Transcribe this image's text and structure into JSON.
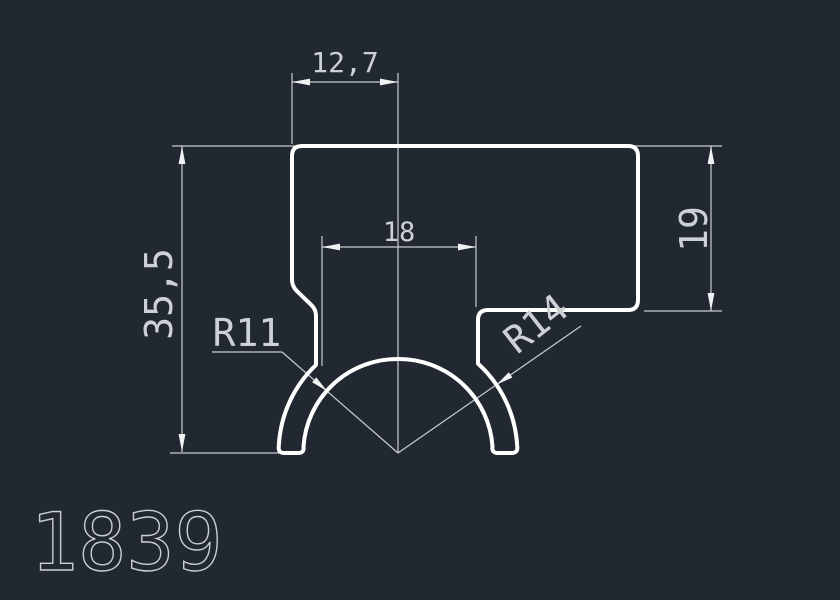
{
  "canvas": {
    "background": "#222831",
    "outline_color": "#ffffff",
    "dimension_color": "#c7ccd1",
    "text_color": "#ccd1d5"
  },
  "title": {
    "part_number": "1839"
  },
  "dimensions": {
    "top_width": "12,7",
    "neck_width": "18",
    "overall_height": "35,5",
    "right_height": "19",
    "inner_radius": "R11",
    "outer_radius": "R14"
  }
}
